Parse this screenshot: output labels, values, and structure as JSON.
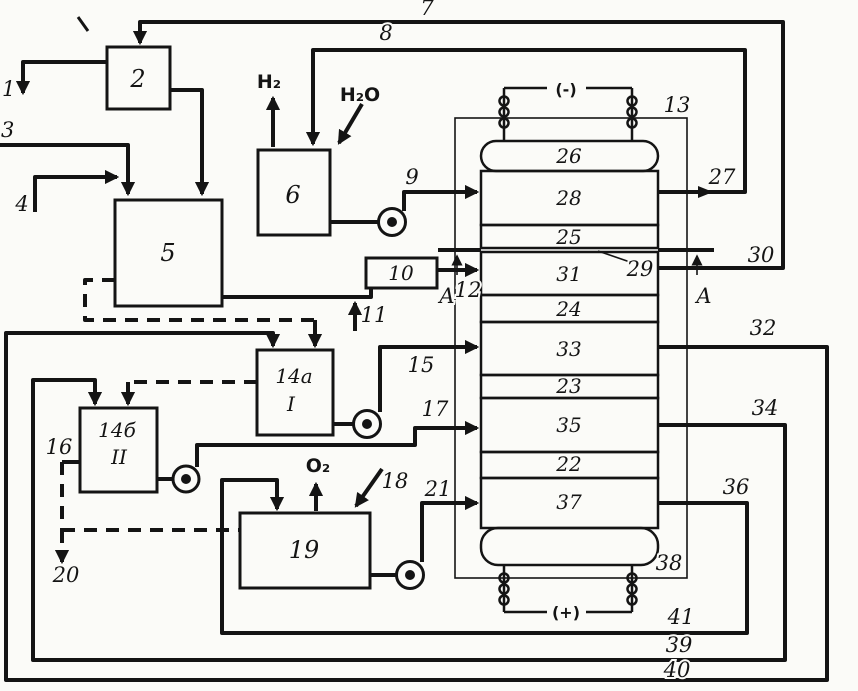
{
  "diagram": {
    "blocks": {
      "b2": "2",
      "b5": "5",
      "b6": "6",
      "b10": "10",
      "b14a": "14a",
      "b14a_roman": "I",
      "b14b": "14б",
      "b14b_roman": "II",
      "b19": "19"
    },
    "column": {
      "casing_label": "13",
      "sections": [
        "26",
        "28",
        "25",
        "31",
        "24",
        "33",
        "23",
        "35",
        "22",
        "37"
      ],
      "section_cut_label": "29",
      "bottom_label": "38",
      "electrode_top": "(-)",
      "electrode_bottom": "(+)",
      "section_view_marker": "A"
    },
    "streams": {
      "s1": "1",
      "s3": "3",
      "s4": "4",
      "s7": "7",
      "s8": "8",
      "s9": "9",
      "s11": "11",
      "s12": "12",
      "s15": "15",
      "s16": "16",
      "s17": "17",
      "s18": "18",
      "s20": "20",
      "s21": "21",
      "s27": "27",
      "s30": "30",
      "s32": "32",
      "s34": "34",
      "s36": "36",
      "s39": "39",
      "s40": "40",
      "s41": "41"
    },
    "chemicals": {
      "hydrogen": "H₂",
      "water": "H₂O",
      "oxygen": "O₂"
    }
  }
}
